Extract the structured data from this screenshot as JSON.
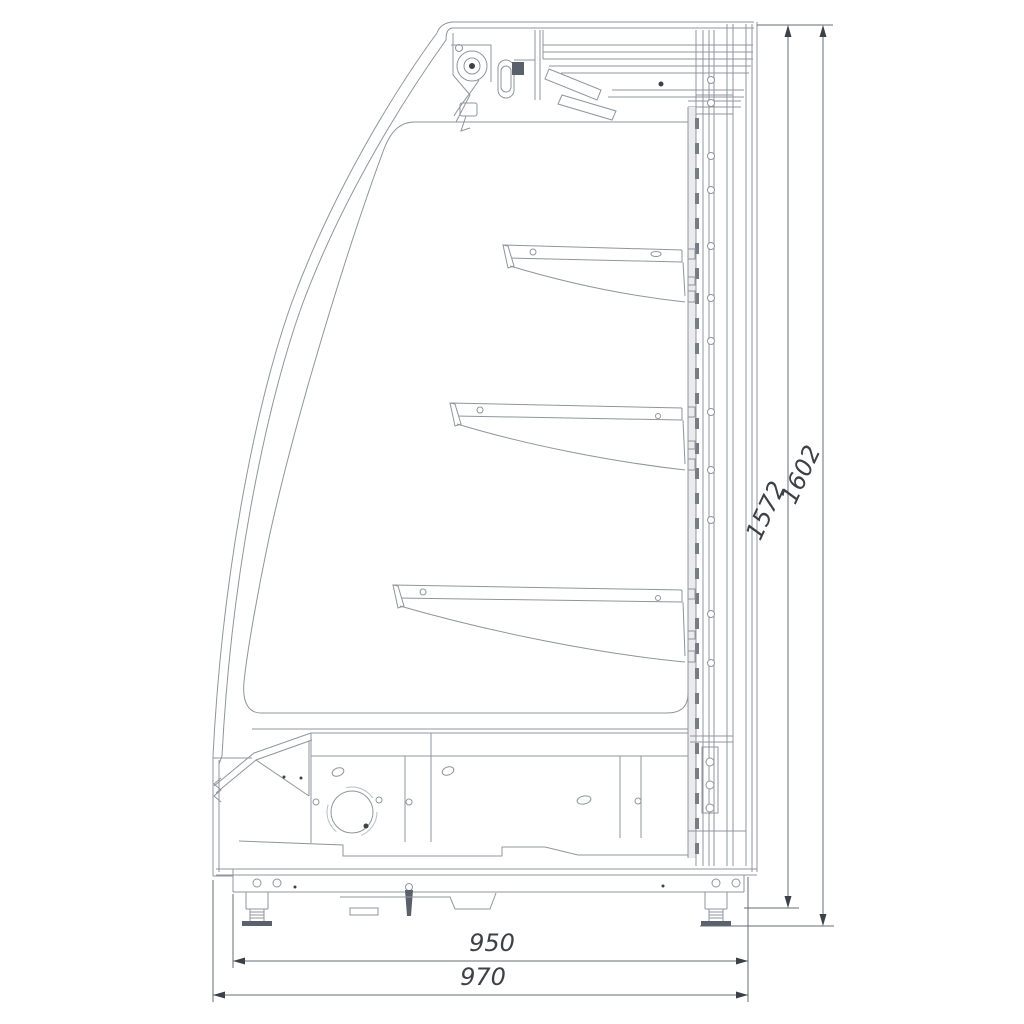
{
  "drawing": {
    "kind": "side-section-technical-drawing",
    "shelf_count": 3,
    "dimensions": {
      "height_body": "1572",
      "height_overall": "1602",
      "depth_base": "950",
      "depth_overall": "970"
    },
    "colors": {
      "background": "#ffffff",
      "line": "#8f959d",
      "dimension_text": "#3c4147"
    }
  }
}
